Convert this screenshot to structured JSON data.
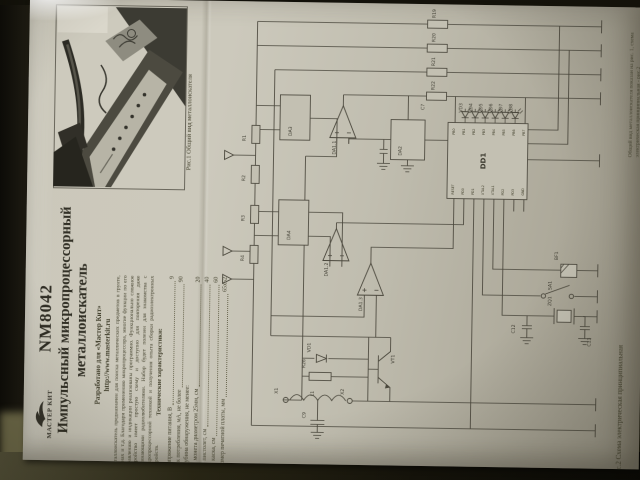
{
  "colors": {
    "paper": "#c7c4b6",
    "table_dark": "#181610",
    "table_olive": "#6e6a49",
    "ink": "#4a473c"
  },
  "header": {
    "logo_text": "МАСТЕР КИТ",
    "model": "NM8042",
    "title_line1": "Импульсный микропроцессорный",
    "title_line2": "металлоискатель",
    "developed_line1": "Разработано для «Мастер Кит»",
    "developed_line2": "http://www.masterkit.ru"
  },
  "intro": "Металлоискатель предназначен для поиска металлических предметов в грунте, стенах и т.д. Благодаря применению микропроцессора, многие функции по его управлению и индикации реализованы программно. Функционально сложное устройство имеет простую схему и доступно для повторения даже начинающими радиолюбителями. Набор будет полезен для знакомства с микропроцессорной техникой и получения опыта сборки радиоэлектронных устройств.",
  "specs": {
    "heading": "Технические характеристики:",
    "items": [
      {
        "label": "Напряжение питания, В",
        "value": "9"
      },
      {
        "label": "Ток потребления, мА, не более",
        "value": "90"
      },
      {
        "label": "Глубина обнаружения, не менее:",
        "value": ""
      },
      {
        "label": "монета диаметром 25мм, см",
        "value": "20"
      },
      {
        "label": "пистолет, см",
        "value": "40"
      },
      {
        "label": "каска, см",
        "value": "60"
      },
      {
        "label": "Размер печатной платы, мм",
        "value": "65х52"
      }
    ]
  },
  "figures": {
    "fig1": "Рис.1 Общий вид металлоискателя",
    "fig2": "Рис.2 Схема электрическая принципиальная",
    "corner_note": "Общий вид металлоискателя показан на рис. 1, схема электрическая принципиальная - рис.2"
  },
  "schematic": {
    "ic_label": "DD1",
    "ic_pins_top": [
      "PB0",
      "PB1",
      "PB2",
      "PB3",
      "PB4",
      "PB5",
      "PB6",
      "PB7"
    ],
    "ic_pins_bottom": [
      "RESET",
      "PD0",
      "PD1",
      "XTAL2",
      "XTAL1",
      "PD2",
      "PD3",
      "GND"
    ],
    "labels": [
      {
        "t": "R19",
        "x": 224,
        "y": 10
      },
      {
        "t": "R20",
        "x": 224,
        "y": 34
      },
      {
        "t": "R21",
        "x": 224,
        "y": 58
      },
      {
        "t": "R22",
        "x": 224,
        "y": 82
      },
      {
        "t": "C7",
        "x": 214,
        "y": 102
      },
      {
        "t": "VD3",
        "x": 252,
        "y": 104
      },
      {
        "t": "VD4",
        "x": 262,
        "y": 104
      },
      {
        "t": "VD5",
        "x": 272,
        "y": 104
      },
      {
        "t": "VD6",
        "x": 282,
        "y": 104
      },
      {
        "t": "VD7",
        "x": 292,
        "y": 104
      },
      {
        "t": "VD8",
        "x": 302,
        "y": 104
      },
      {
        "t": "DD1",
        "x": 276,
        "y": 152,
        "big": true
      },
      {
        "t": "DA1.1",
        "x": 126,
        "y": 148
      },
      {
        "t": "DA1.2",
        "x": 120,
        "y": 270
      },
      {
        "t": "DA1.3",
        "x": 155,
        "y": 304
      },
      {
        "t": "DA2",
        "x": 192,
        "y": 148
      },
      {
        "t": "DA3",
        "x": 82,
        "y": 130
      },
      {
        "t": "DA4",
        "x": 82,
        "y": 234
      },
      {
        "t": "R1",
        "x": 36,
        "y": 136
      },
      {
        "t": "R2",
        "x": 36,
        "y": 176
      },
      {
        "t": "R3",
        "x": 36,
        "y": 216
      },
      {
        "t": "R4",
        "x": 36,
        "y": 256
      },
      {
        "t": "VD1",
        "x": 104,
        "y": 346
      },
      {
        "t": "R26",
        "x": 99,
        "y": 362
      },
      {
        "t": "L1",
        "x": 108,
        "y": 390
      },
      {
        "t": "X1",
        "x": 72,
        "y": 388
      },
      {
        "t": "X2",
        "x": 138,
        "y": 388
      },
      {
        "t": "VT1",
        "x": 188,
        "y": 356
      },
      {
        "t": "C9",
        "x": 100,
        "y": 412
      },
      {
        "t": "BF1",
        "x": 350,
        "y": 250
      },
      {
        "t": "SA1",
        "x": 344,
        "y": 280
      },
      {
        "t": "ZQ1",
        "x": 344,
        "y": 296
      },
      {
        "t": "C12",
        "x": 308,
        "y": 324
      },
      {
        "t": "C13",
        "x": 384,
        "y": 336
      }
    ]
  }
}
